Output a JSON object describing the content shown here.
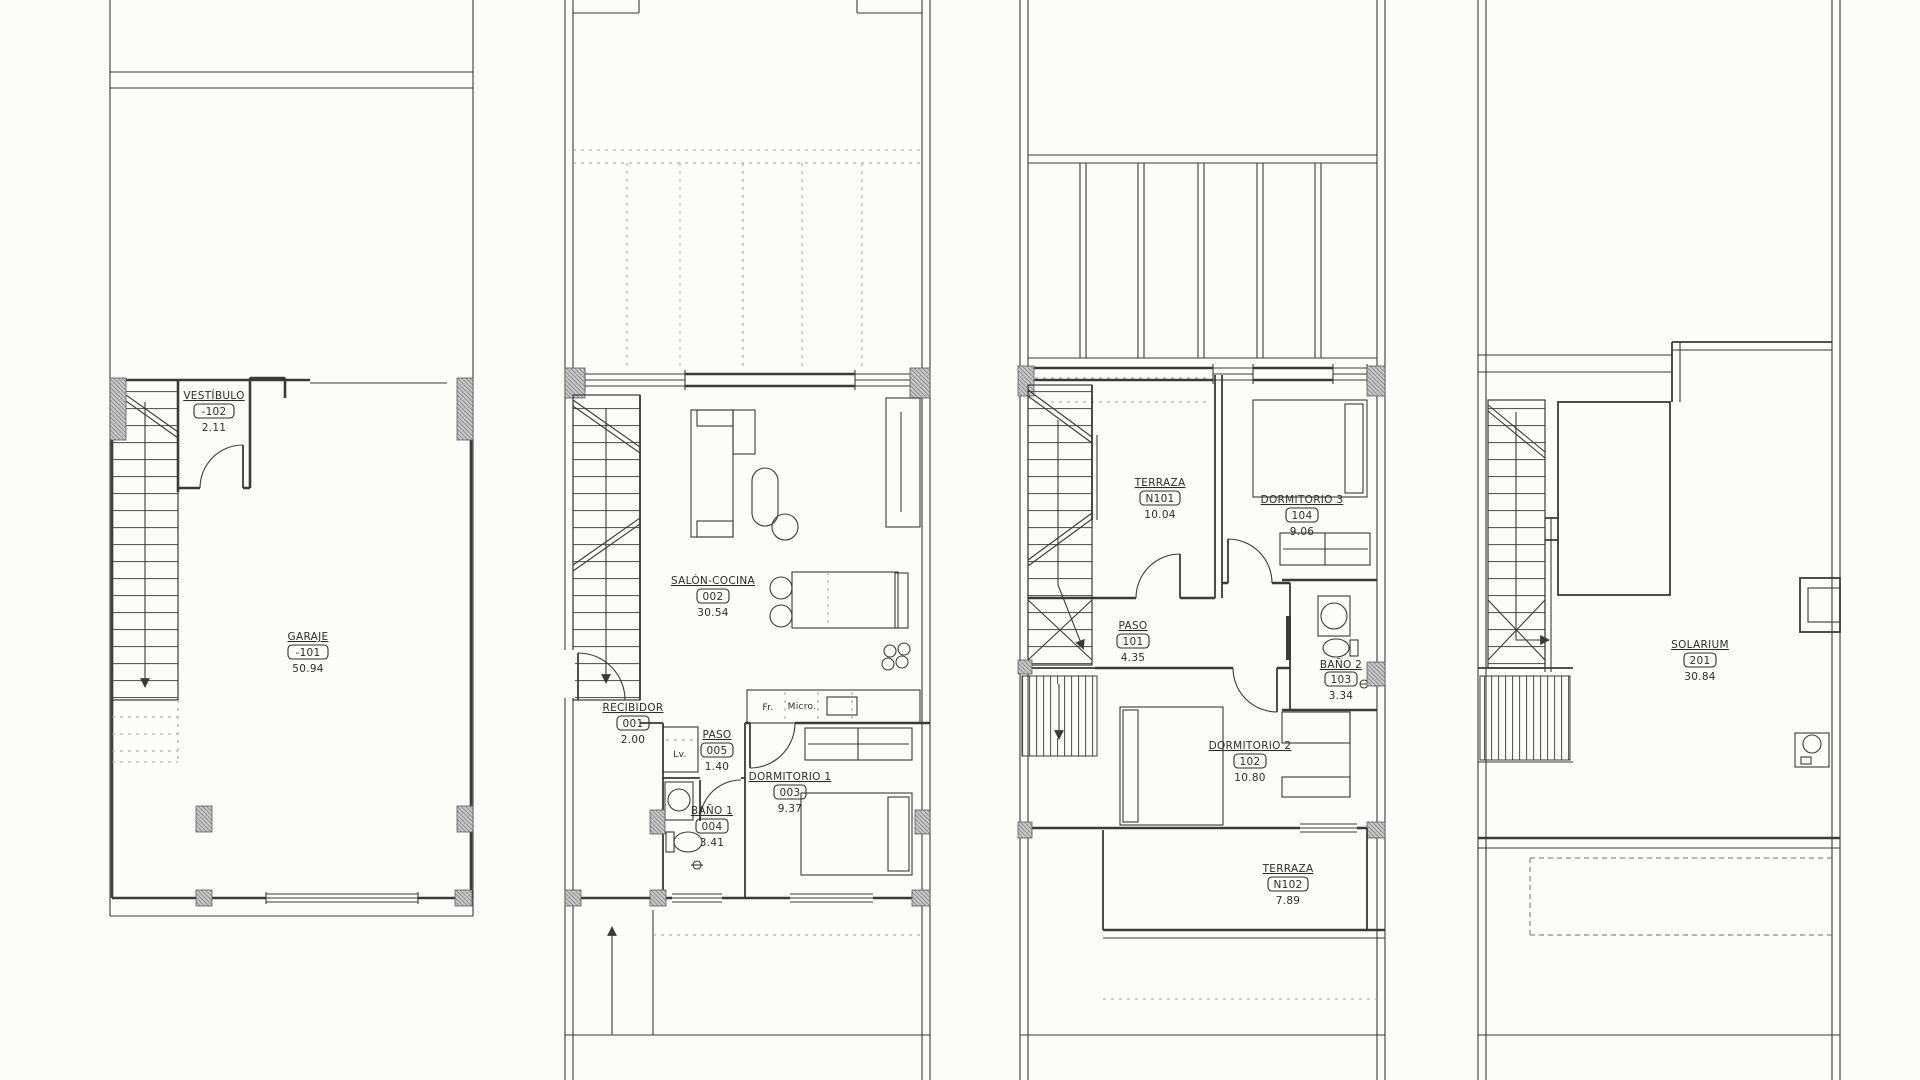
{
  "document": {
    "kind": "architectural floor plan sheet",
    "levels": [
      "basement-garage",
      "ground-floor",
      "first-floor",
      "roof-solarium"
    ]
  },
  "colors": {
    "paper": "#fcfcfa",
    "line": "#3a3a3a",
    "pier_fill": "#c8c8c8",
    "paving_dash": "#9f9f9f"
  },
  "plans": [
    {
      "id": "basement-garage",
      "rooms": [
        {
          "name": "VESTÍBULO",
          "code": "-102",
          "area": "2.11"
        },
        {
          "name": "GARAJE",
          "code": "-101",
          "area": "50.94"
        }
      ]
    },
    {
      "id": "ground-floor",
      "rooms": [
        {
          "name": "SALÓN-COCINA",
          "code": "002",
          "area": "30.54"
        },
        {
          "name": "RECIBIDOR",
          "code": "001",
          "area": "2.00"
        },
        {
          "name": "PASO",
          "code": "005",
          "area": "1.40"
        },
        {
          "name": "DORMITORIO 1",
          "code": "003",
          "area": "9.37"
        },
        {
          "name": "BAÑO 1",
          "code": "004",
          "area": "3.41"
        }
      ],
      "appliances": [
        {
          "label": "Lv."
        },
        {
          "label": "Fr."
        },
        {
          "label": "Micro."
        }
      ]
    },
    {
      "id": "first-floor",
      "rooms": [
        {
          "name": "TERRAZA",
          "code": "N101",
          "area": "10.04"
        },
        {
          "name": "DORMITORIO 3",
          "code": "104",
          "area": "9.06"
        },
        {
          "name": "PASO",
          "code": "101",
          "area": "4.35"
        },
        {
          "name": "BAÑO 2",
          "code": "103",
          "area": "3.34"
        },
        {
          "name": "DORMITORIO 2",
          "code": "102",
          "area": "10.80"
        },
        {
          "name": "TERRAZA",
          "code": "N102",
          "area": "7.89"
        }
      ]
    },
    {
      "id": "roof-solarium",
      "rooms": [
        {
          "name": "SOLARIUM",
          "code": "201",
          "area": "30.84"
        }
      ]
    }
  ]
}
